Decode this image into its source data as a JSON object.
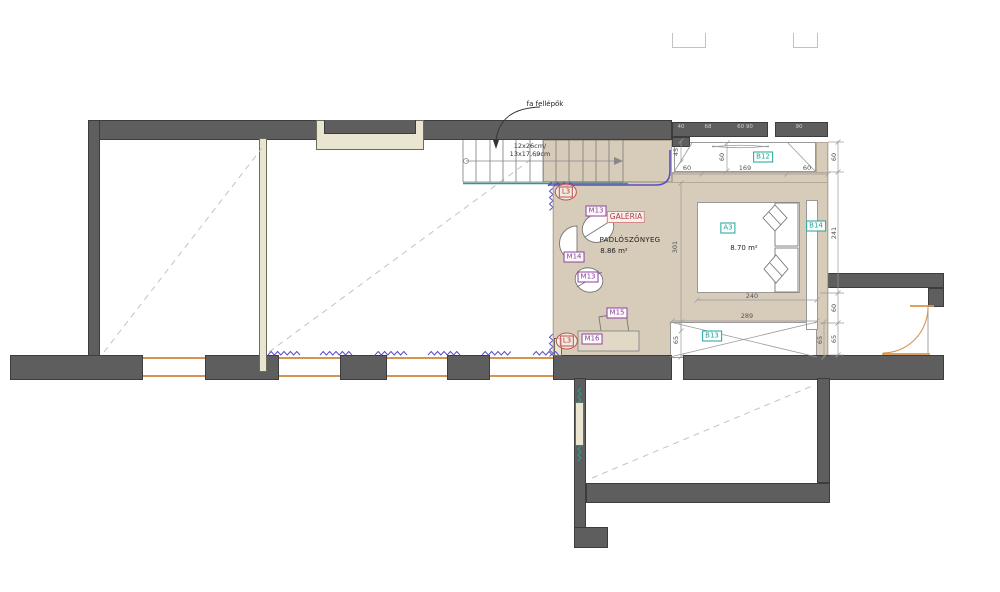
{
  "document": {
    "kind": "architectural floor plan — gallery level"
  },
  "annotations": {
    "stair_note": "fa fellépők",
    "stair_size_line1": "12x26cm/",
    "stair_size_line2": "13x17,69cm",
    "gallery_name": "GALÉRIA",
    "gallery_floor": "PADLÓSZŐNYEG",
    "gallery_area": "8.86 m²",
    "a3_area": "8.70 m²"
  },
  "tags": {
    "l3_top": "L3",
    "l3_bottom": "L3",
    "m13_top": "M13",
    "m13_mid": "M13",
    "m14": "M14",
    "m15": "M15",
    "m16": "M16",
    "a3": "A3",
    "b12": "B12",
    "b13": "B13",
    "b14": "B14"
  },
  "dimensions": {
    "top_chain": [
      "60",
      "169",
      "60"
    ],
    "step_depth": "45",
    "niche_depth": "60",
    "gallery_height": "301",
    "bed_zone_width": "240",
    "balcony_width": "289",
    "balcony_depth_left": "65",
    "balcony_depth_right": "65",
    "right_chain": [
      "60",
      "241",
      "60",
      "65"
    ],
    "wall_marks": [
      "40",
      "68",
      "60 90",
      "90"
    ]
  },
  "colors": {
    "wall": "#5e5e5e",
    "floor_beige": "#d7ccba",
    "frame_beige": "#e9e5d1",
    "teal": "#1fa399",
    "purple": "#8e3f9e",
    "red": "#c0504d",
    "window_orange": "#d6954f",
    "rail_purple": "#5a4fbf"
  }
}
